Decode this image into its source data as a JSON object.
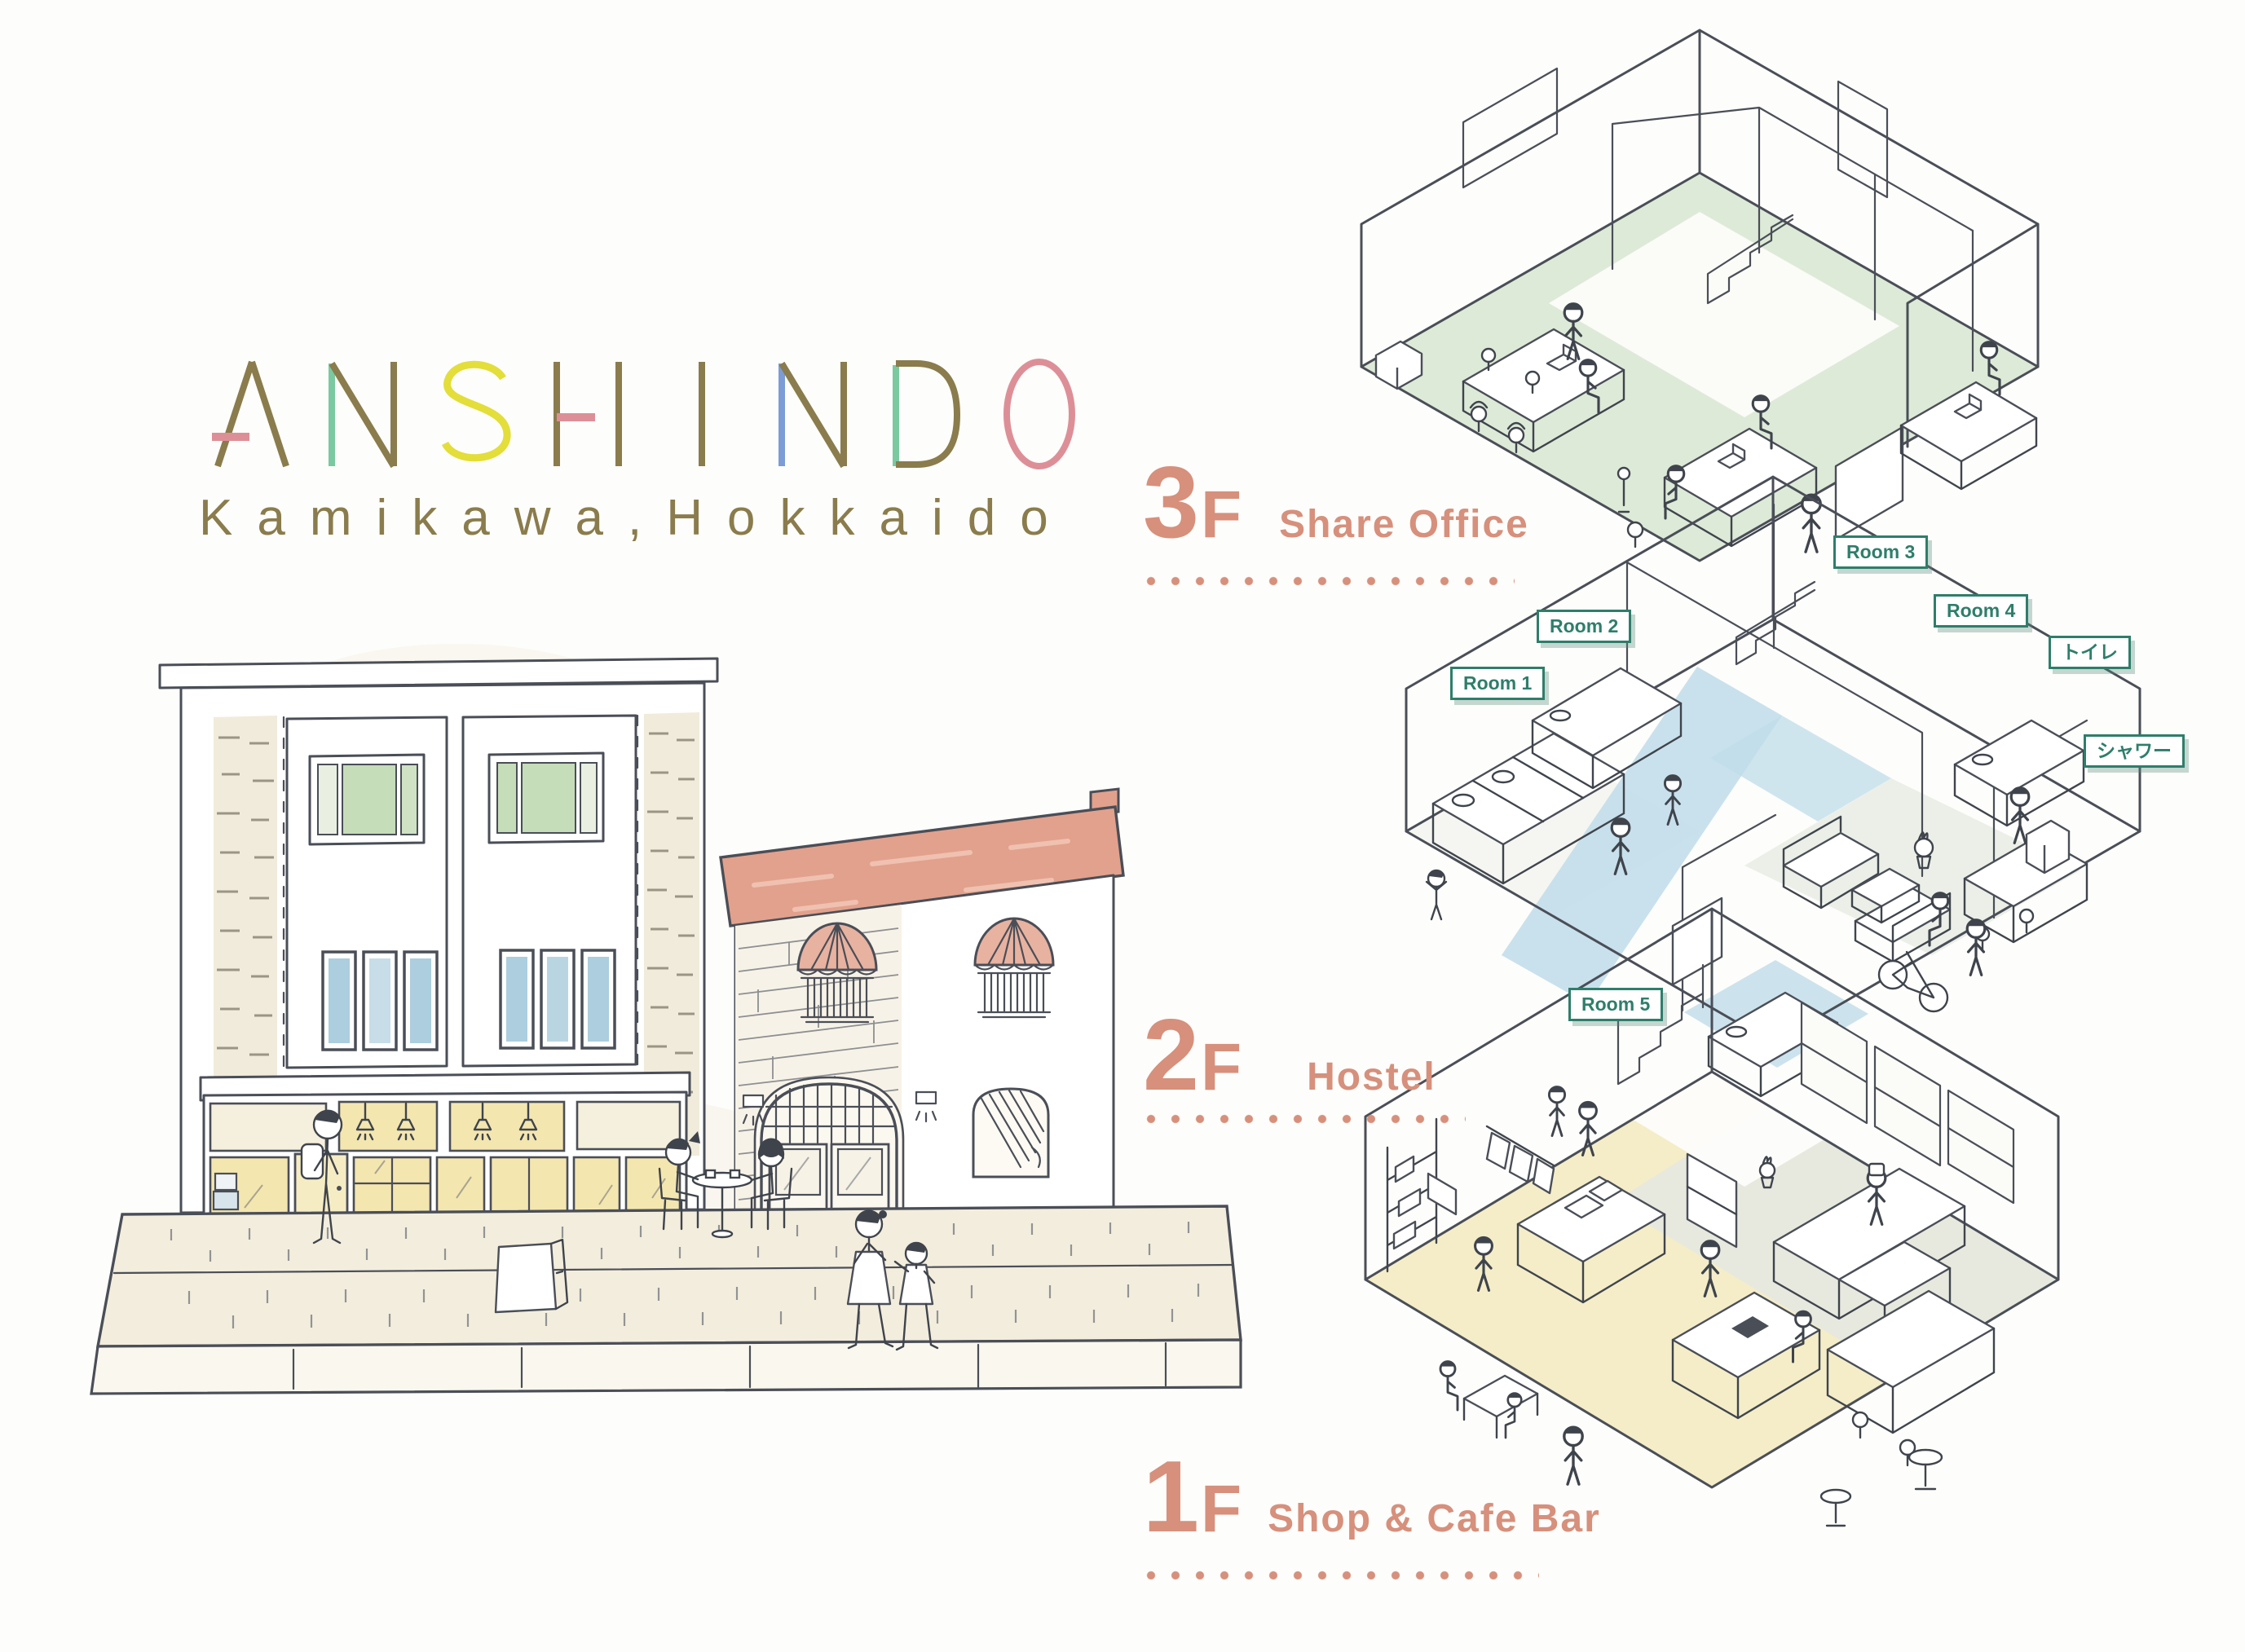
{
  "page": {
    "title": "ANSHINDO Kamikawa, Hokkaido floor guide"
  },
  "logo": {
    "name": "ANSHINDO",
    "subtitle": "Kamikawa,Hokkaido"
  },
  "floors": [
    {
      "level": "3",
      "suffix": "F",
      "name": "Share Office"
    },
    {
      "level": "2",
      "suffix": "F",
      "name": "Hostel"
    },
    {
      "level": "1",
      "suffix": "F",
      "name": "Shop & Cafe Bar"
    }
  ],
  "rooms": {
    "room1": "Room 1",
    "room2": "Room 2",
    "room3": "Room 3",
    "room4": "Room 4",
    "room5": "Room 5",
    "toilet": "トイレ",
    "shower": "シャワー"
  },
  "colors": {
    "accent_coral": "#D6907C",
    "tag_teal": "#2E7E6B",
    "logo_olive": "#8A7C4C",
    "logo_pink": "#DD8F97",
    "logo_yellow": "#E3DE39",
    "logo_mint": "#7BC9A1",
    "logo_blue": "#7C9CD7",
    "floor3_tint": "#DAE8D4",
    "floor2_tint": "#BFDCEA",
    "floor2_lounge": "#E8ECE4",
    "floor1_tint": "#F3EBC3",
    "floor1_kitchen": "#E5E8E1",
    "ink": "#4A4E57"
  }
}
